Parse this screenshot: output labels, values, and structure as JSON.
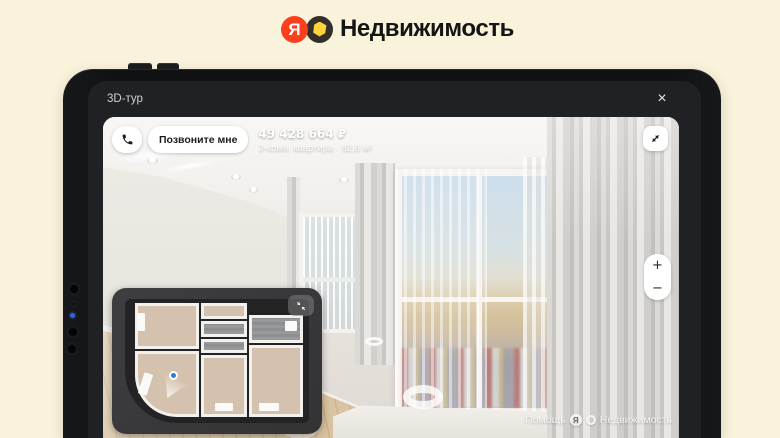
{
  "header": {
    "brand": "Недвижимость",
    "logo_letter": "Я"
  },
  "dialog": {
    "title": "3D-тур",
    "close_glyph": "×"
  },
  "viewer": {
    "toolbar": {
      "call_label": "Позвоните мне"
    },
    "listing": {
      "price": "49 428 664 ₽",
      "details": "3-комн. квартира · 82,6 м²"
    },
    "zoom": {
      "plus": "+",
      "minus": "−"
    },
    "watermark": {
      "help": "Помощь",
      "logo_letter": "Я",
      "brand": "Недвижимость"
    }
  },
  "colors": {
    "page_background": "#faf3dc",
    "logo_red": "#fc3f1d",
    "logo_yellow": "#ffd43b",
    "tablet_frame": "#121315",
    "screen_background": "#202124",
    "position_dot_blue": "#2e7bdf"
  }
}
